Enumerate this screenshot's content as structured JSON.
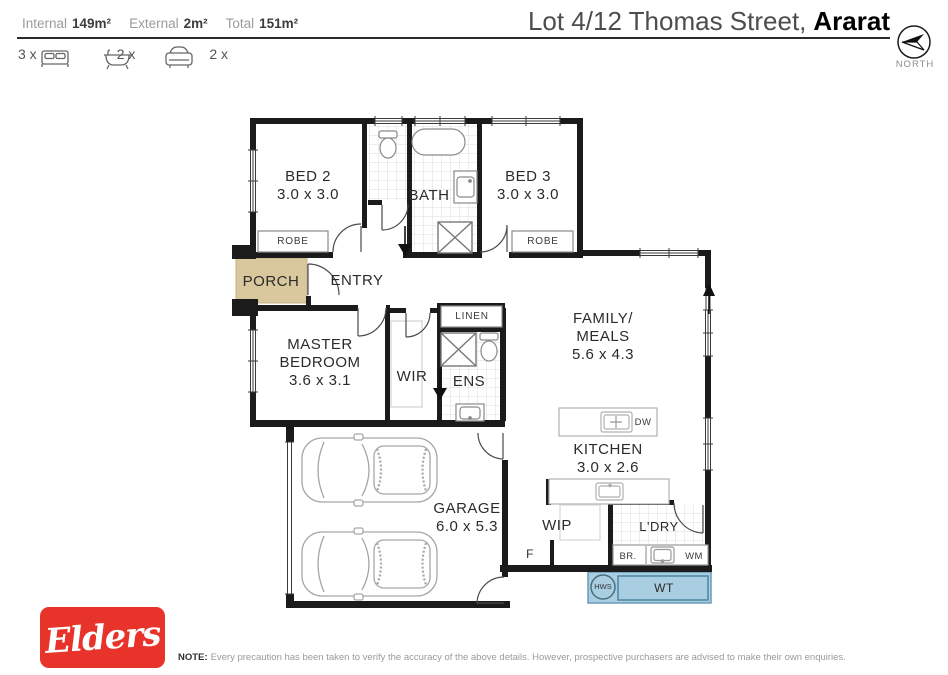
{
  "colors": {
    "wall": "#1b1b1b",
    "porch_fill": "#d9c79d",
    "water_fill": "#a9cee1",
    "water_stroke": "#4a86a1",
    "brand_red": "#e8332a"
  },
  "header": {
    "stats": [
      {
        "label": "Internal",
        "value": "149m²"
      },
      {
        "label": "External",
        "value": "2m²"
      },
      {
        "label": "Total",
        "value": "151m²"
      }
    ],
    "title_regular": "Lot 4/12 Thomas Street,",
    "title_bold": "Ararat",
    "north_label": "NORTH",
    "amenities": [
      {
        "count": "3 x",
        "icon": "bed-icon"
      },
      {
        "count": "2 x",
        "icon": "bath-icon"
      },
      {
        "count": "2 x",
        "icon": "car-icon"
      }
    ]
  },
  "floorplan": {
    "rooms": {
      "bed2": {
        "name": "BED 2",
        "dims": "3.0 x 3.0"
      },
      "bath": {
        "name": "BATH"
      },
      "bed3": {
        "name": "BED 3",
        "dims": "3.0 x 3.0"
      },
      "porch": {
        "name": "PORCH"
      },
      "entry": {
        "name": "ENTRY"
      },
      "master": {
        "name1": "MASTER",
        "name2": "BEDROOM",
        "dims": "3.6 x 3.1"
      },
      "wir": {
        "name": "WIR"
      },
      "ens": {
        "name": "ENS"
      },
      "family": {
        "name1": "FAMILY/",
        "name2": "MEALS",
        "dims": "5.6 x 4.3"
      },
      "kitchen": {
        "name": "KITCHEN",
        "dims": "3.0 x 2.6"
      },
      "garage": {
        "name": "GARAGE",
        "dims": "6.0 x 5.3"
      },
      "wip": {
        "name": "WIP"
      },
      "ldry": {
        "name": "L'DRY"
      }
    },
    "features": {
      "robe2": "ROBE",
      "robe3": "ROBE",
      "linen": "LINEN",
      "dw": "DW",
      "fridge": "F",
      "broom": "BR.",
      "washer": "WM",
      "hws": "HWS",
      "water_tank": "WT"
    }
  },
  "footer": {
    "brand": "Elders",
    "note_label": "NOTE:",
    "note_text": "Every precaution has been taken to verify the accuracy of the above details. However, prospective purchasers are advised to make their own enquiries."
  }
}
